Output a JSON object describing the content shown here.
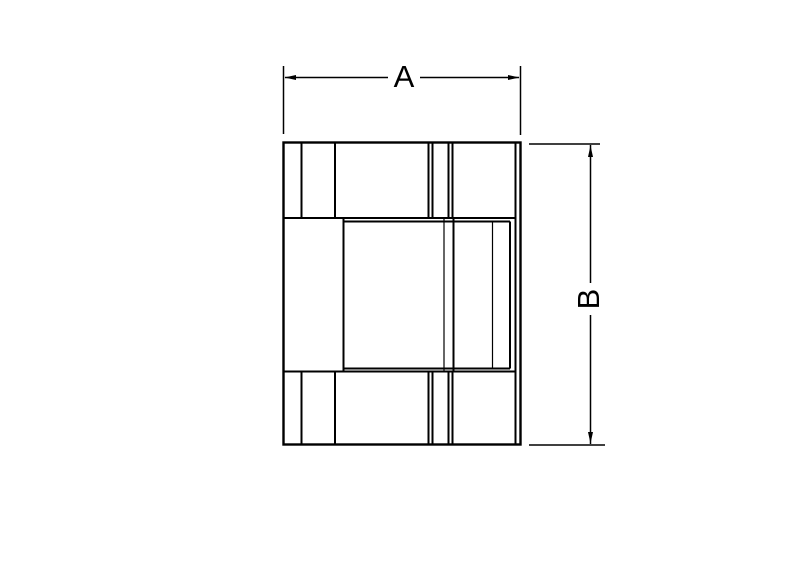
{
  "drawing": {
    "type": "technical-dimension-drawing",
    "dimensions": {
      "a": {
        "label": "A",
        "orientation": "horizontal"
      },
      "b": {
        "label": "B",
        "orientation": "vertical"
      }
    },
    "colors": {
      "line": "#000000",
      "background": "#ffffff"
    }
  }
}
